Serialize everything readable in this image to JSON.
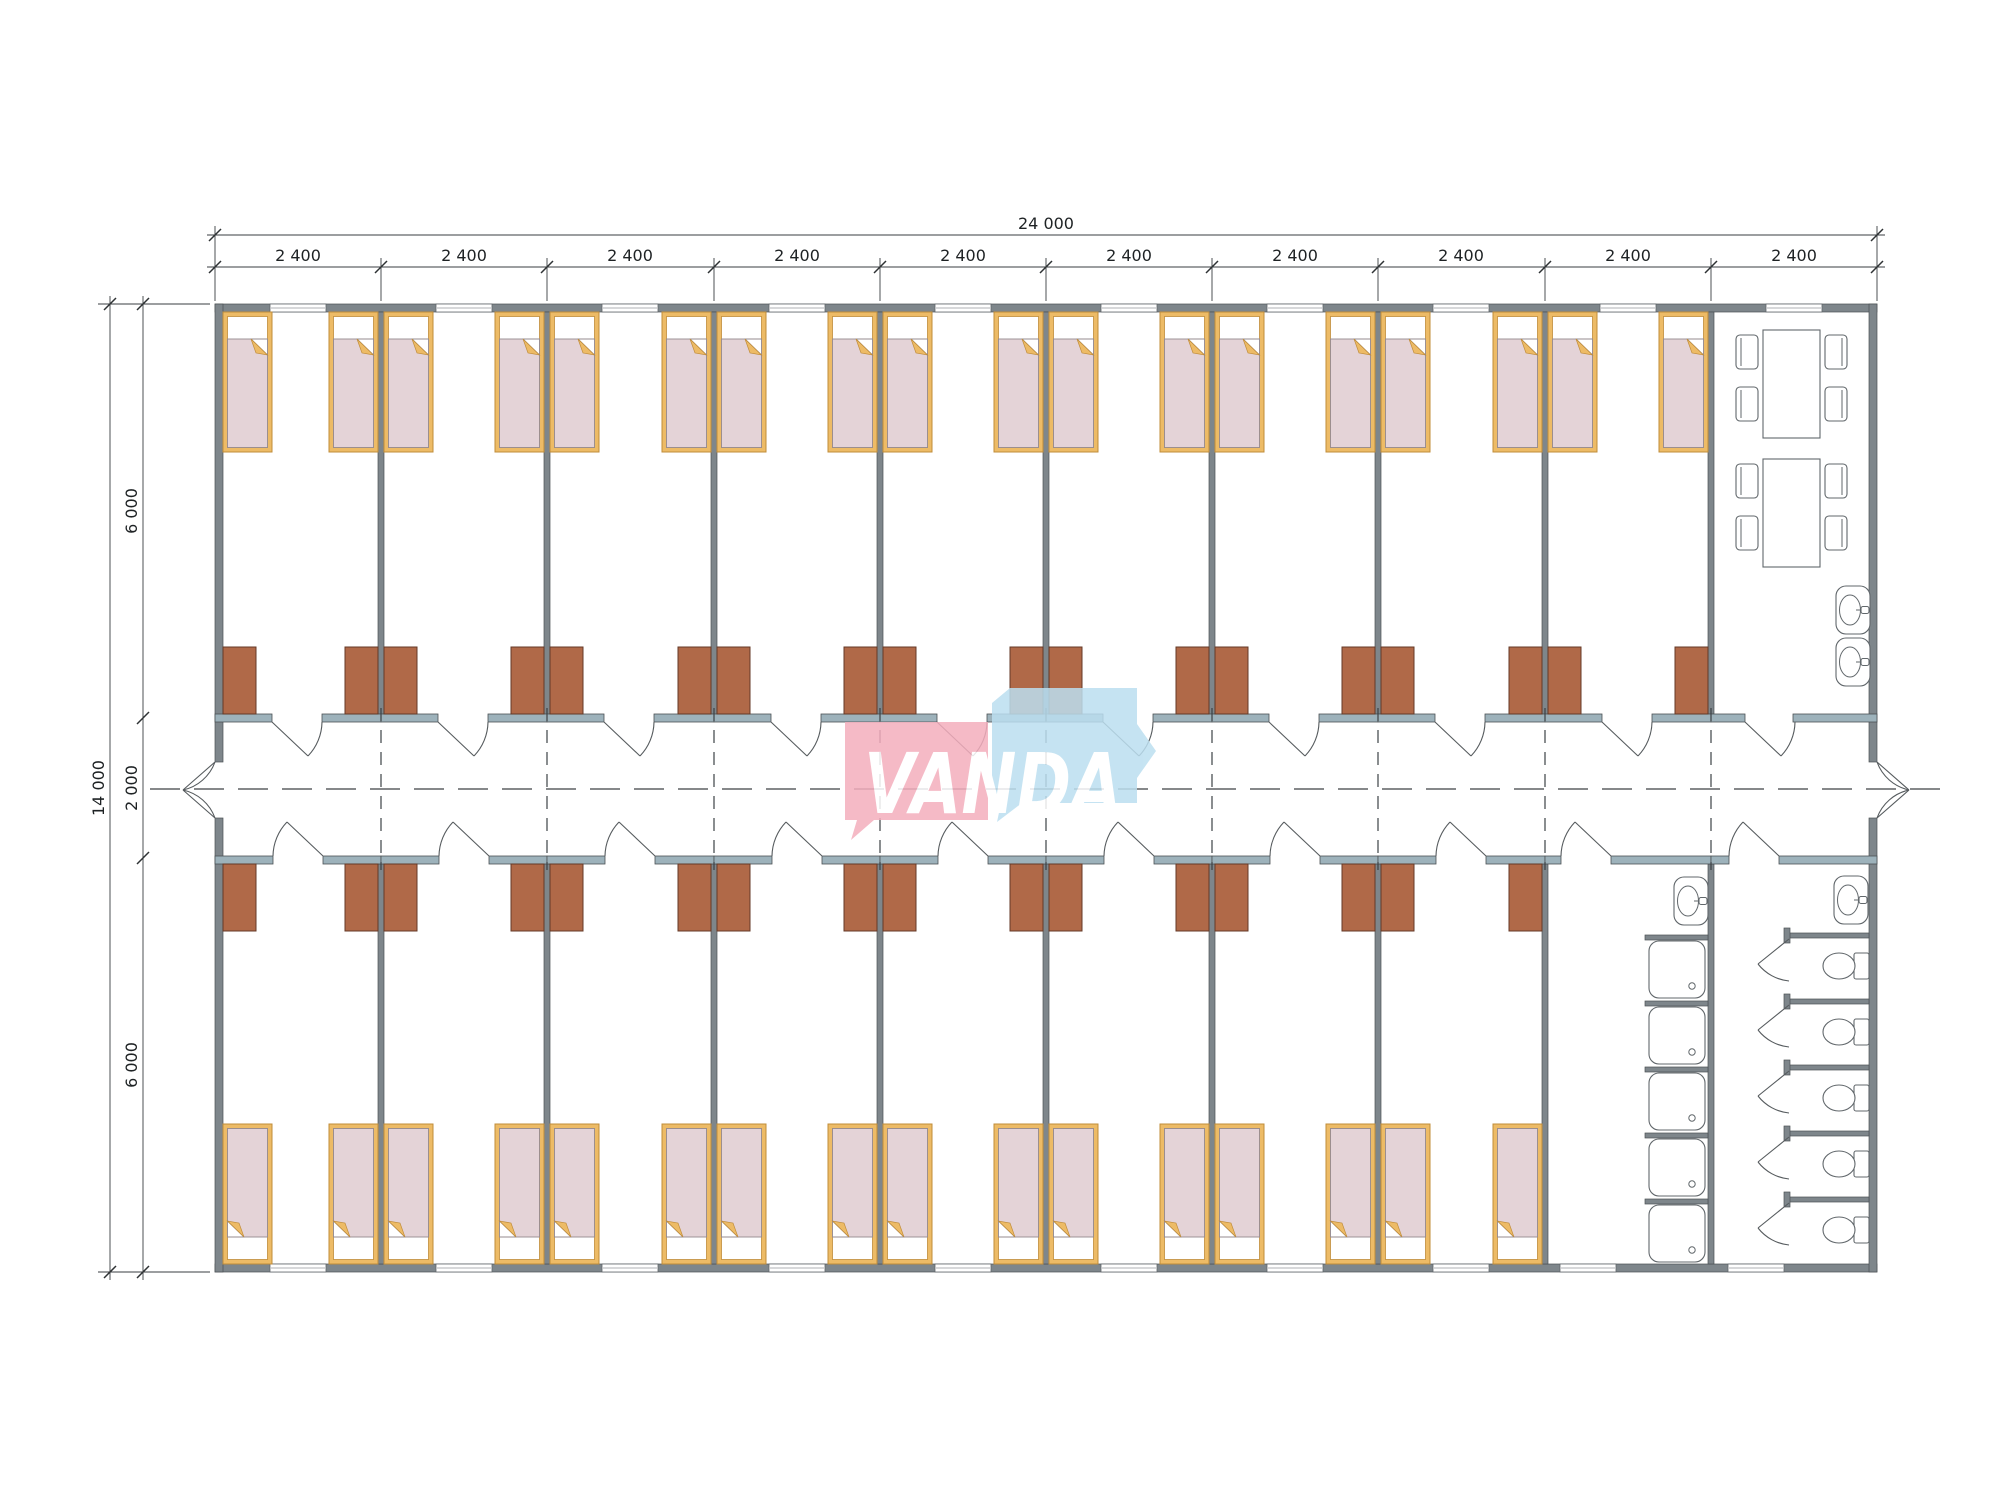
{
  "logo": {
    "brand": "VANDA"
  },
  "dimensions": {
    "overall_width": "24 000",
    "module_width": "2 400",
    "overall_height": "14 000",
    "top_room_depth": "6 000",
    "corridor_width": "2 000",
    "bottom_room_depth": "6 000"
  },
  "layout": {
    "modules": 10,
    "beds_top_row": 18,
    "beds_bottom_row": 16,
    "wardrobes": 34,
    "dining_tables": 2,
    "dining_chairs": 8,
    "wash_basins": 4,
    "showers": 5,
    "toilet_stalls": 5,
    "corridor_doors_top": 10,
    "corridor_doors_bottom": 10,
    "entrance_doors": 2
  },
  "colors": {
    "wall": "#7e868b",
    "wallStroke": "#4c5154",
    "corrWall": "#9db2bb",
    "wardrobe": "#b06948",
    "wardrobeStroke": "#643927",
    "bedFrame": "#edbb66",
    "bedEdge": "#c08c3a",
    "blanket": "#e4d3d7",
    "blanketEdge": "#958b8f",
    "fixture": "#61676b",
    "dash": "#3d4245",
    "dim": "#3a3e41",
    "logoPink": "#f4aebd",
    "logoBlue": "#bcdff0"
  }
}
